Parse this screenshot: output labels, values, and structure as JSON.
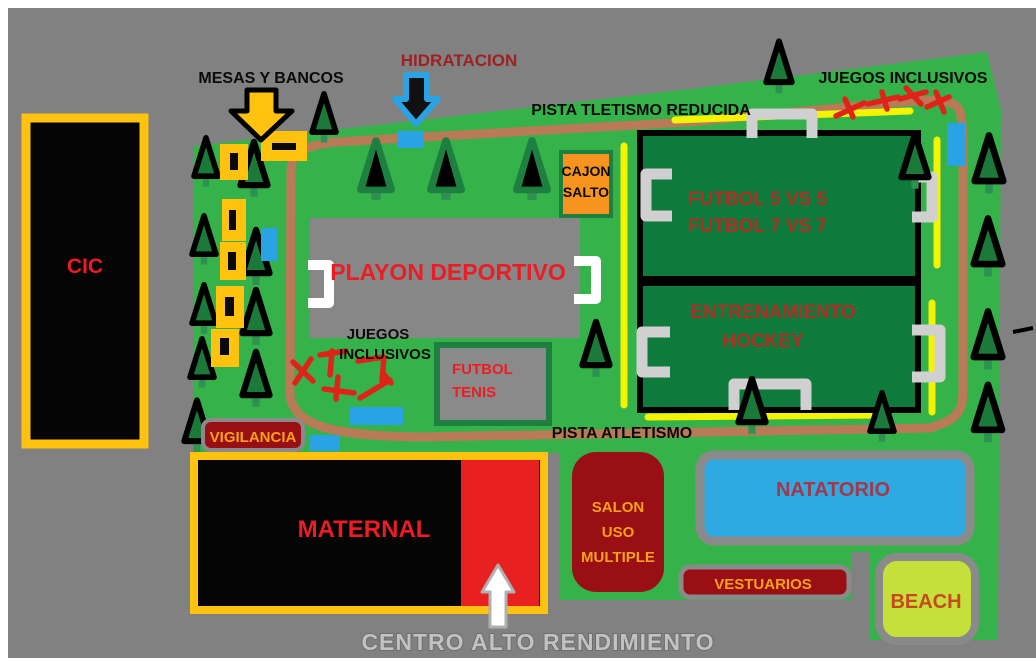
{
  "title": "Sports facility site map",
  "colors": {
    "bg": "#818181",
    "park_green": "#35B24A",
    "field_green": "#0E7A3B",
    "tree_green": "#1B7A3A",
    "trunk_green": "#2E9152",
    "path_brown": "#B97A57",
    "track_yellow": "#F4F400",
    "gold": "#FFC20E",
    "dark_red": "#990F14",
    "bright_red": "#E8201F",
    "red_text": "#EC1C24",
    "field_red_text": "#AF3026",
    "dark_red_text": "#9E2022",
    "orange_text": "#F7A11B",
    "orange_box": "#F7941D",
    "blue": "#29A3E3",
    "natatorio_blue": "#2FA9E1",
    "natatorio_text": "#A23848",
    "beach_green": "#C6E03B",
    "beach_text": "#C74A1C",
    "goal_white": "#FFFFFF",
    "goal_gray": "#D0D0D0",
    "scribble_red": "#E02318",
    "playon_gray": "#878787",
    "centro_text": "#C2C2C2",
    "centro_outline": "#6E6E6E"
  },
  "labels": {
    "mesas_y_bancos": "MESAS Y BANCOS",
    "hidratacion": "HIDRATACION",
    "pista_tletismo_reducida": "PISTA TLETISMO REDUCIDA",
    "juegos_inclusivos_top": "JUEGOS INCLUSIVOS",
    "cajon_salto": [
      "CAJON",
      "SALTO"
    ],
    "futbol_5": "FUTBOL 5 VS 5",
    "futbol_7": "FUTBOL 7 VS 7",
    "entrenamiento_hockey": [
      "ENTRENAMIENTO",
      "HOCKEY"
    ],
    "playon_deportivo": "PLAYON DEPORTIVO",
    "juegos_inclusivos_left": [
      "JUEGOS",
      "INCLUSIVOS"
    ],
    "futbol_tenis": [
      "FUTBOL",
      "TENIS"
    ],
    "vigilancia": "VIGILANCIA",
    "pista_atletismo": "PISTA ATLETISMO",
    "cic": "CIC",
    "maternal": "MATERNAL",
    "salon_uso_multiple": [
      "SALON",
      "USO",
      "MULTIPLE"
    ],
    "natatorio": "NATATORIO",
    "vestuarios": "VESTUARIOS",
    "beach": "BEACH",
    "centro_alto_rendimiento": "CENTRO ALTO RENDIMIENTO"
  }
}
